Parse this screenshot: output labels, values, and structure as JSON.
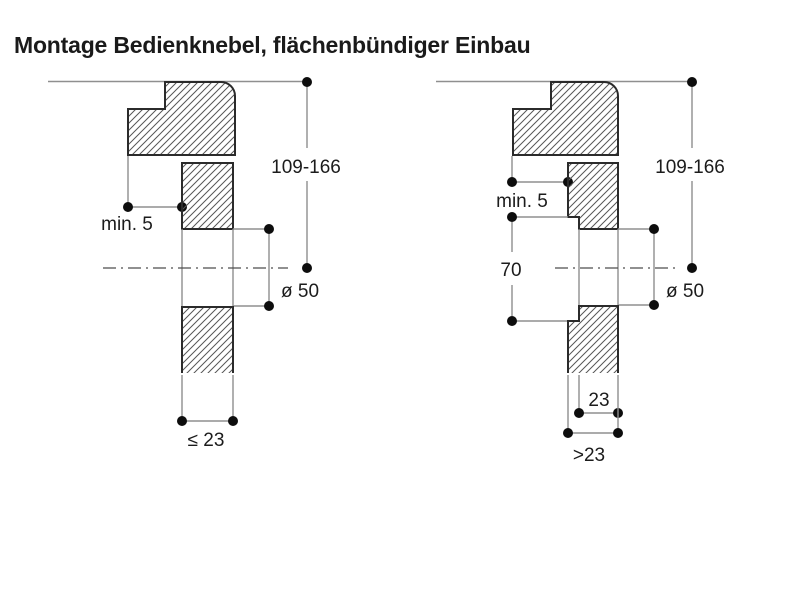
{
  "title": "Montage Bedienknebel, flächenbündiger Einbau",
  "colors": {
    "background": "#ffffff",
    "ink": "#1a1a1a",
    "dimension_line": "#8f8f8f"
  },
  "figures": {
    "left": {
      "labels": {
        "height_range": "109-166",
        "min_overlap": "min. 5",
        "knob_diameter": "ø 50",
        "panel_thickness": "≤ 23"
      }
    },
    "right": {
      "labels": {
        "height_range": "109-166",
        "min_overlap": "min. 5",
        "recess_height": "70",
        "knob_diameter": "ø 50",
        "cutout_width": "23",
        "panel_thickness": ">23"
      }
    }
  }
}
